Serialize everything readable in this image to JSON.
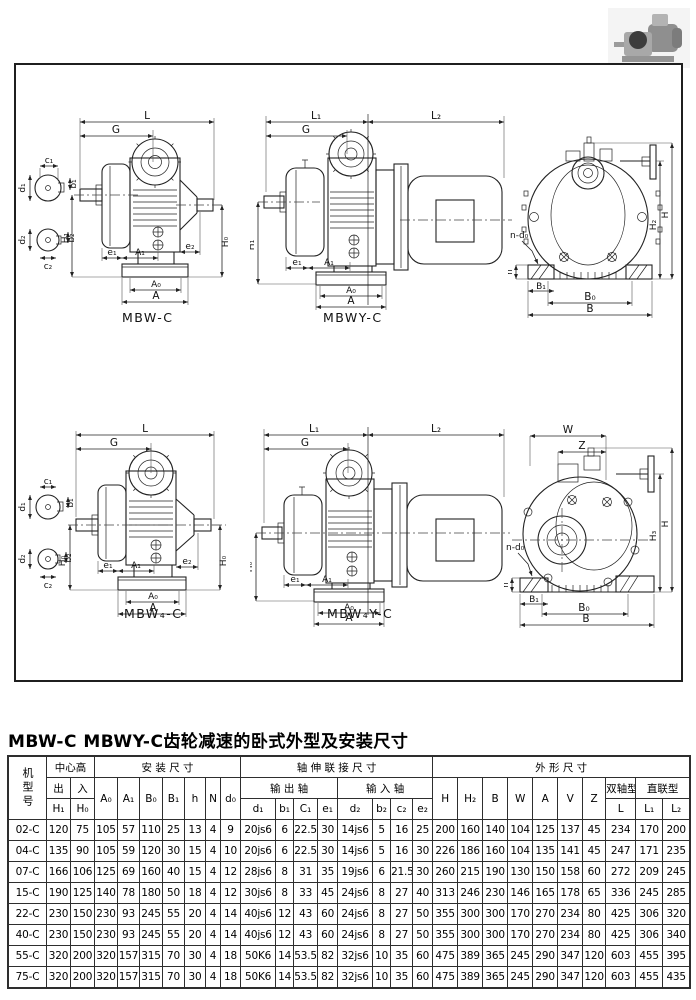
{
  "page": {
    "title": "MBW-C MBWY-C齿轮减速的卧式外型及安装尺寸"
  },
  "drawings": {
    "side1": {
      "caption": "MBW-C",
      "L": "L",
      "G": "G",
      "H1": "H₁",
      "H0": "H₀",
      "e1": "e₁",
      "A1": "A₁",
      "e2": "e₂",
      "A0": "A₀",
      "A": "A",
      "c1": "c₁",
      "b1": "b₁",
      "d1": "d₁",
      "c2": "c₂",
      "b2": "b₂",
      "d2": "d₂"
    },
    "side2": {
      "caption": "MBWY-C",
      "L1": "L₁",
      "L2": "L₂",
      "G": "G",
      "H1": "H₁",
      "e1": "e₁",
      "A1": "A₁",
      "A0": "A₀",
      "A": "A"
    },
    "end1": {
      "ndo": "n-d₀",
      "h": "h",
      "B1": "B₁",
      "B0": "B₀",
      "B": "B",
      "H2": "H₂",
      "H": "H"
    },
    "side3": {
      "caption": "MBW₄-C",
      "L": "L",
      "G": "G",
      "H0l": "H₀",
      "H0r": "H₀",
      "e1": "e₁",
      "A1": "A₁",
      "e2": "e₂",
      "A0": "A₀",
      "A": "A",
      "c1": "c₁",
      "b1": "b₁",
      "d1": "d₁",
      "c2": "c₂",
      "b2": "b₂",
      "d2": "d₂"
    },
    "side4": {
      "caption": "MBW₄Y-C",
      "L1": "L₁",
      "L2": "L₂",
      "G": "G",
      "H0": "H₀",
      "e1": "e₁",
      "A1": "A₁",
      "A0": "A₀",
      "A": "A"
    },
    "end2": {
      "W": "W",
      "Z": "Z",
      "ndo": "n-d₀",
      "h": "h",
      "B1": "B₁",
      "B0": "B₀",
      "B": "B",
      "H3": "H₃",
      "H": "H"
    }
  },
  "table": {
    "header": {
      "model": "机型号",
      "center_height": "中心高",
      "out": "出",
      "in": "入",
      "H1": "H₁",
      "H0": "H₀",
      "mounting": "安 装 尺 寸",
      "A0": "A₀",
      "A1": "A₁",
      "B0": "B₀",
      "B1": "B₁",
      "h": "h",
      "N": "N",
      "d0": "d₀",
      "shaft": "轴 伸 联 接 尺 寸",
      "output_shaft": "输 出 轴",
      "input_shaft": "输 入 轴",
      "d1": "d₁",
      "b1": "b₁",
      "C1": "C₁",
      "e1": "e₁",
      "d2": "d₂",
      "b2": "b₂",
      "c2": "c₂",
      "e2": "e₂",
      "outline": "外 形 尺 寸",
      "H": "H",
      "H2": "H₂",
      "B": "B",
      "W": "W",
      "A": "A",
      "V": "V",
      "Z": "Z",
      "dual": "双轴型",
      "direct": "直联型",
      "L": "L",
      "L1": "L₁",
      "L2": "L₂"
    },
    "rows": [
      [
        "02-C",
        "120",
        "75",
        "105",
        "57",
        "110",
        "25",
        "13",
        "4",
        "9",
        "20js6",
        "6",
        "22.5",
        "30",
        "14js6",
        "5",
        "16",
        "25",
        "200",
        "160",
        "140",
        "104",
        "125",
        "137",
        "45",
        "234",
        "170",
        "200"
      ],
      [
        "04-C",
        "135",
        "90",
        "105",
        "59",
        "120",
        "30",
        "15",
        "4",
        "10",
        "20js6",
        "6",
        "22.5",
        "30",
        "14js6",
        "5",
        "16",
        "30",
        "226",
        "186",
        "160",
        "104",
        "135",
        "141",
        "45",
        "247",
        "171",
        "235"
      ],
      [
        "07-C",
        "166",
        "106",
        "125",
        "69",
        "160",
        "40",
        "15",
        "4",
        "12",
        "28js6",
        "8",
        "31",
        "35",
        "19js6",
        "6",
        "21.5",
        "30",
        "260",
        "215",
        "190",
        "130",
        "150",
        "158",
        "60",
        "272",
        "209",
        "245"
      ],
      [
        "15-C",
        "190",
        "125",
        "140",
        "78",
        "180",
        "50",
        "18",
        "4",
        "12",
        "30js6",
        "8",
        "33",
        "45",
        "24js6",
        "8",
        "27",
        "40",
        "313",
        "246",
        "230",
        "146",
        "165",
        "178",
        "65",
        "336",
        "245",
        "285"
      ],
      [
        "22-C",
        "230",
        "150",
        "230",
        "93",
        "245",
        "55",
        "20",
        "4",
        "14",
        "40js6",
        "12",
        "43",
        "60",
        "24js6",
        "8",
        "27",
        "50",
        "355",
        "300",
        "300",
        "170",
        "270",
        "234",
        "80",
        "425",
        "306",
        "320"
      ],
      [
        "40-C",
        "230",
        "150",
        "230",
        "93",
        "245",
        "55",
        "20",
        "4",
        "14",
        "40js6",
        "12",
        "43",
        "60",
        "24js6",
        "8",
        "27",
        "50",
        "355",
        "300",
        "300",
        "170",
        "270",
        "234",
        "80",
        "425",
        "306",
        "340"
      ],
      [
        "55-C",
        "320",
        "200",
        "320",
        "157",
        "315",
        "70",
        "30",
        "4",
        "18",
        "50K6",
        "14",
        "53.5",
        "82",
        "32js6",
        "10",
        "35",
        "60",
        "475",
        "389",
        "365",
        "245",
        "290",
        "347",
        "120",
        "603",
        "455",
        "395"
      ],
      [
        "75-C",
        "320",
        "200",
        "320",
        "157",
        "315",
        "70",
        "30",
        "4",
        "18",
        "50K6",
        "14",
        "53.5",
        "82",
        "32js6",
        "10",
        "35",
        "60",
        "475",
        "389",
        "365",
        "245",
        "290",
        "347",
        "120",
        "603",
        "455",
        "435"
      ]
    ]
  }
}
